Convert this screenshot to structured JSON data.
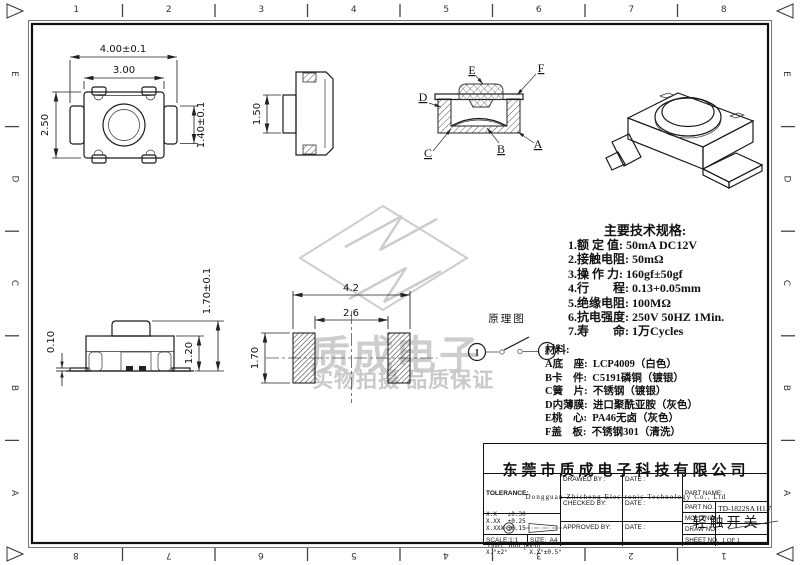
{
  "sheet": {
    "background": "#ffffff",
    "line_color": "#1a1a1a",
    "watermark_color": "#cccccc"
  },
  "border": {
    "columns": [
      "1",
      "2",
      "3",
      "4",
      "5",
      "6",
      "7",
      "8"
    ],
    "rows": [
      "E",
      "D",
      "C",
      "B",
      "A"
    ]
  },
  "views": {
    "top_view": {
      "dim_outer": "4.00±0.1",
      "dim_inner": "3.00",
      "dim_height": "2.50",
      "dim_tab": "1.40±0.1"
    },
    "side_view": {
      "dim_button": "1.50"
    },
    "section_view": {
      "label_a": "A",
      "label_b": "B",
      "label_c": "C",
      "label_d": "D",
      "label_e": "E",
      "label_f": "F"
    },
    "front_view": {
      "dim_standoff": "0.10",
      "dim_body": "1.20",
      "dim_total": "1.70±0.1"
    },
    "footprint": {
      "dim_outer": "4.2",
      "dim_inner": "2.6",
      "dim_pad": "1.70"
    },
    "schematic": {
      "title": "原理图",
      "terminal_1": "1",
      "terminal_2": "2"
    }
  },
  "watermark": {
    "line1": "质成电子",
    "line2": "实物拍摄 品质保证"
  },
  "specs": {
    "title": "主要技术规格:",
    "items": [
      "1.额 定 值: 50mA DC12V",
      "2.接触电阻: 50mΩ",
      "3.操 作 力: 160gf±50gf",
      "4.行　　程: 0.13+0.05mm",
      "5.绝缘电阻: 100MΩ",
      "6.抗电强度: 250V 50HZ 1Min.",
      "7.寿　　命: 1万Cycles"
    ],
    "materials_title": "材料:",
    "materials": [
      "A底　座:  LCP4009（白色）",
      "B卡　件:  C5191磷铜（镀银）",
      "C簧　片:  不锈钢（镀银）",
      "D内薄膜:  进口聚酰亚胺（灰色）",
      "E桃　心:  PA46无卤（灰色）",
      "F盖　板:  不锈钢301（清洗）"
    ]
  },
  "title_block": {
    "company_cn": "东莞市质成电子科技有限公司",
    "company_en": "Dongguan Zhicheng Electronic Technology Co., Ltd",
    "tolerance_title": "TOLERANCE:",
    "tolerances": [
      "X.X   ±0.30",
      "X.XX  ±0.25",
      "X.XXX ±0.15"
    ],
    "angle_tolerance": "X.°±2°      X.X°±0.5°",
    "unit_label": "UNIT:  mm  [inch]",
    "scale_label": "SCALE:1:1",
    "size_label": "SIZE:  A4",
    "drawed_by_label": "DRAWED BY :",
    "checked_by_label": "CHECKED BY:",
    "approved_by_label": "APPROVED BY:",
    "date_label": "DATE :",
    "part_name_label": "PART NAME:",
    "part_name": "轻触开关",
    "part_no_label": "PART NO.",
    "part_no": "TD-1822SA H1.7",
    "mold_no_label": "MOLD NO.",
    "draw_no_label": "DRAW NO:",
    "sheet_no_label": "SHEET NO.",
    "sheet_no": "1 OF 1"
  }
}
